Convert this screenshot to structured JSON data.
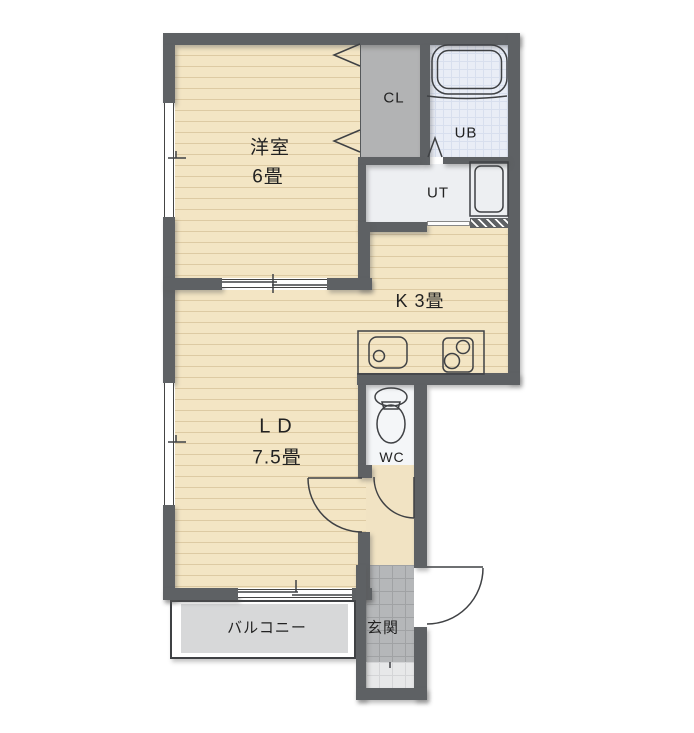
{
  "floorplan": {
    "rooms": {
      "western": {
        "name": "洋室",
        "size": "6畳"
      },
      "living_dining": {
        "name": "L D",
        "size": "7.5畳"
      },
      "kitchen": {
        "name": "K 3畳"
      },
      "closet": {
        "name": "CL"
      },
      "unit_bath": {
        "name": "UB"
      },
      "utility": {
        "name": "UT"
      },
      "toilet": {
        "name": "WC"
      },
      "balcony": {
        "name": "バルコニー"
      },
      "entrance": {
        "name": "玄関"
      }
    },
    "colors": {
      "wall": "#5e6164",
      "floor_wood": "#f3e5c4",
      "floor_wood_line": "#ddcaa3",
      "closet_fill": "#b2b3b4",
      "bath_floor": "#e9edf6",
      "utility_floor": "#edeff2",
      "wc_floor": "#f4f6f8",
      "tile_dark": "#b5b7b9",
      "tile_light": "#e7e8e9",
      "balcony_floor": "#d7d8d9"
    }
  }
}
